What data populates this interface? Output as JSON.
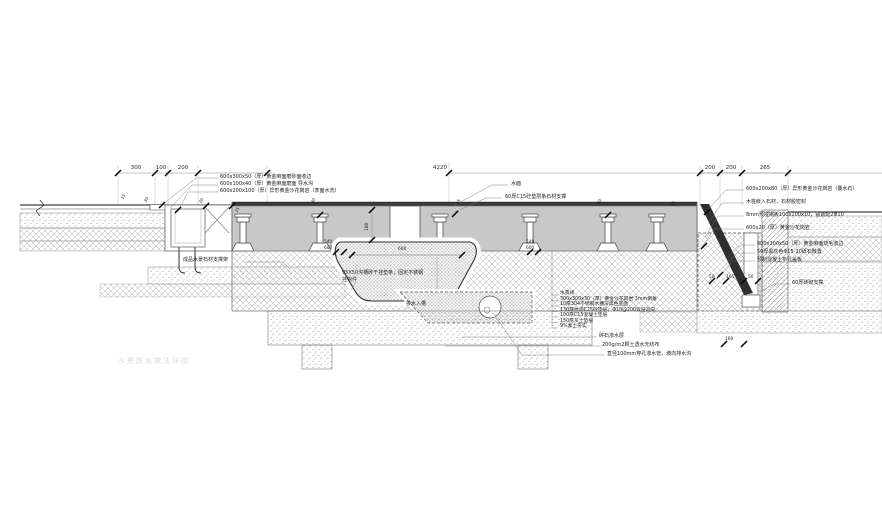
{
  "watermark": "水景跌水做法详图",
  "dims": {
    "top_left": [
      "300",
      "100",
      "200"
    ],
    "overall": "4220",
    "top_right": [
      "200",
      "200",
      "265"
    ],
    "basin_left": [
      "540",
      "600"
    ],
    "basin_center": "600",
    "basin_right": [
      "540",
      "600"
    ],
    "column_height": "180",
    "pit": [
      "50",
      "165",
      "50"
    ],
    "pit_bottom": "160",
    "small_marks": [
      "15",
      "30",
      "20",
      "25",
      "30",
      "15",
      "20",
      "15"
    ]
  },
  "callouts": {
    "top_left": [
      "600x300x50（厚）黄金麻面磨砂面收边",
      "600x100x40（厚）黄金麻面磨面 导水沟",
      "600x200x100（厚）异形黄金沙花岗岩（表面水洗）"
    ],
    "top_center": [
      "水面",
      "60厚C15砼垫层条石材支撑"
    ],
    "top_right": [
      "600x200x80（厚）异形黄金沙花岗岩（叠水石）",
      "木桩嵌入石材，石材胶密封",
      "8mm预埋钢板100x100x10，锚筋配2Φ10",
      "600x20（厚）黄金沙花岗岩"
    ],
    "mid_right": [
      "600x300x50（厚）黄金麻面烧毛收边",
      "50厚黑灰色Φ15-20砾石散置",
      "预制混凝土布孔盖板"
    ],
    "right_lower": "60厚砖砌支撑",
    "left_mid": "成品水景石材支撑架",
    "basin_side": [
      "95X50沟槽砖干挂垫条，固定不锈钢",
      "挂钩件"
    ],
    "basin_below": "排水入槽",
    "layer_stack": [
      "水景线",
      "300x300x30（厚）黄金沙花岗岩 3mm倒角",
      "10厚304不锈钢水槽深黑色亚面",
      "130厚抗渗C25砼垫层，Φ10@200双层双向",
      "100厚C15混凝土垫层",
      "150厚灰土垫层",
      "9%素土夯实"
    ],
    "bottom": [
      "碎石渗水层",
      "200g/m2颗土透水无纺布",
      "直径100mm穿孔渗水管，坡向排水沟"
    ]
  }
}
